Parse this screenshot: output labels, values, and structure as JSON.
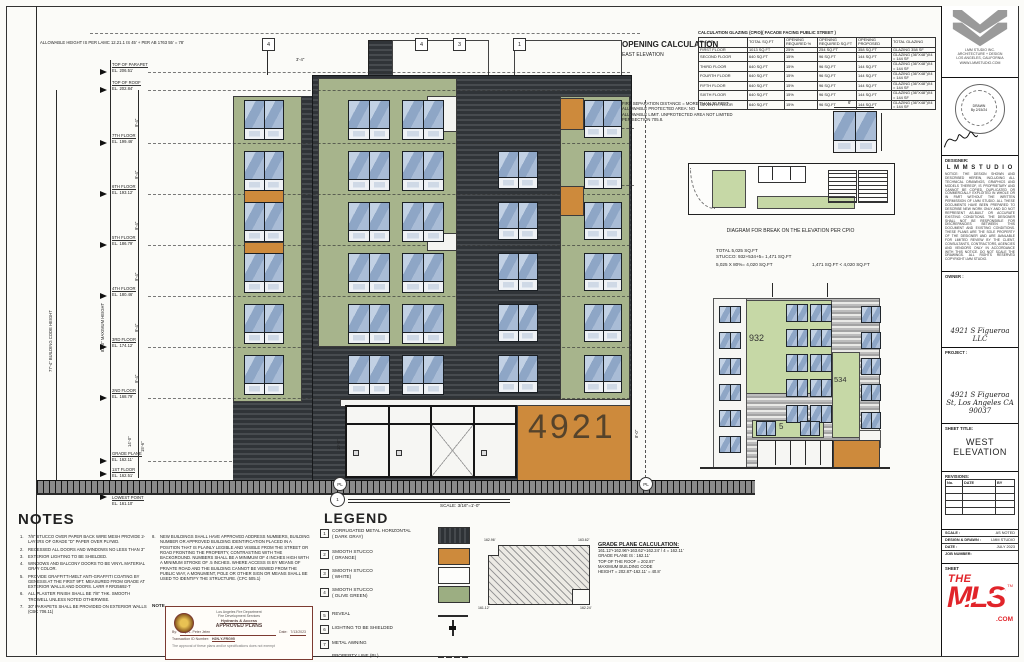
{
  "colors": {
    "olive": "#a7b48c",
    "light_green": "#c6d8a6",
    "orange": "#cd8a3c",
    "dark_metal": "#3a3e42",
    "window_blue": "#8ea6c6",
    "mls_red": "#e1242a",
    "stamp_maroon": "#7c3a31"
  },
  "grid_bubbles": [
    "4",
    "4",
    "3",
    "1"
  ],
  "dims": {
    "allowable": "ALLOWABLE HEIGHT IS PER LAMC 12.21.1 IS 45' + PER AB 1763 55' = 78'",
    "floor": "9'-4\"",
    "first": "14'-0\"",
    "ground": "15'-6\"",
    "right": "8'-0\"",
    "left": "10'-0\"",
    "top": "3'-4\"",
    "win": "6'",
    "bch": "77'-4\"  BUILDING CODE HEIGHT",
    "maxh": "82'-0\"  MAXIMUM HEIGHT"
  },
  "levels": [
    {
      "label": "TOP OF PARAPET",
      "el": "EL. 206.51'"
    },
    {
      "label": "TOP OF ROOF",
      "el": "EL. 202.84'"
    },
    {
      "label": "7TH FLOOR",
      "el": "EL. 199.46'"
    },
    {
      "label": "6TH FLOOR",
      "el": "EL. 193.12'"
    },
    {
      "label": "5TH FLOOR",
      "el": "EL. 186.79'"
    },
    {
      "label": "4TH FLOOR",
      "el": "EL. 180.46'"
    },
    {
      "label": "3RD FLOOR",
      "el": "EL. 174.12'"
    },
    {
      "label": "2ND FLOOR",
      "el": "EL. 168.79'"
    },
    {
      "label": "GRADE PLANE",
      "el": "EL. 162.11'"
    },
    {
      "label": "1ST FLOOR",
      "el": "EL. 162.51'"
    },
    {
      "label": "LOWEST POINT",
      "el": "EL. 161.10'"
    }
  ],
  "building": {
    "number": "4921",
    "pl": "PL"
  },
  "opening_calc": {
    "heading": "OPENING CALCULATION",
    "sub": "EAST ELEVATION",
    "table_title": "CALCULATION GLAZING (CPIO)( FACADE FACING PUBLIC STREET )",
    "headers": [
      "FLOOR",
      "TOTAL SQ.FT",
      "OPENING REQUIRED %",
      "OPENING REQUIRED SQ.FT",
      "OPENING PROPOSED",
      "TOTAL GLAZING"
    ],
    "rows": [
      [
        "FIRST FLOOR",
        "1013 SQ.FT",
        "25%",
        "254 SQ.FT",
        "358 SQ.FT",
        "GLAZING 358 SF"
      ],
      [
        "SECOND FLOOR",
        "640 SQ.FT",
        "15%",
        "96 SQ.FT",
        "144 SQ.FT",
        "GLAZING (36\"X48\")X4 = 144 SF"
      ],
      [
        "THIRD FLOOR",
        "640 SQ.FT",
        "15%",
        "96 SQ.FT",
        "144 SQ.FT",
        "GLAZING (36\"X48\")X4 = 144 SF"
      ],
      [
        "FOURTH FLOOR",
        "640 SQ.FT",
        "15%",
        "96 SQ.FT",
        "144 SQ.FT",
        "GLAZING (36\"X48\")X4 = 144 SF"
      ],
      [
        "FIFTH FLOOR",
        "640 SQ.FT",
        "15%",
        "96 SQ.FT",
        "144 SQ.FT",
        "GLAZING (36\"X48\")X4 = 144 SF"
      ],
      [
        "SIXTH FLOOR",
        "640 SQ.FT",
        "15%",
        "96 SQ.FT",
        "144 SQ.FT",
        "GLAZING (36\"X48\")X4 = 144 SF"
      ],
      [
        "SEVENTH FLOOR",
        "640 SQ.FT",
        "15%",
        "96 SQ.FT",
        "144 SQ.FT",
        "GLAZING (36\"X48\")X4 = 144 SF"
      ]
    ]
  },
  "fire_note": {
    "lines": [
      "FIRE SEPARATION DISTANCE = MORE THAN 30 FEET",
      "ALLOWABLE PROTECTED AREA: NO",
      "ALLOWABLE LIMIT. UNPROTECTED AREA NOT LIMITED",
      "PER SECTION 705.8."
    ]
  },
  "break_diagram": {
    "title": "DIAGRAM FOR BREAK ON THE ELEVATION PER CPIO",
    "calc1": "TOTAL 5,025 SQ.FT",
    "calc2": "STUCCO: 932+534+5= 1,471 SQ.FT",
    "calc3a": "5,025 X 80%= 4,020 SQ.FT",
    "calc3b": "1,471 SQ.FT < 4,020 SQ.FT",
    "area1": "932",
    "area2": "534",
    "area3": "5"
  },
  "east_elevation": {
    "num": "1",
    "title": "EAST ELEVATION",
    "scale": "SCALE: 3/16\"=1'-0\""
  },
  "notes": {
    "title": "NOTES",
    "items": [
      {
        "n": "1.",
        "t": "7/8\" STUCCO OVER PAPER BACK WIRE MESH PROVIDE 2-LAYERS OF GRADE \"D\" PAPER OVER PLYWD."
      },
      {
        "n": "2.",
        "t": "RECESSED ALL DOORS AND WINDOWS NO LESS THAN 3\""
      },
      {
        "n": "3.",
        "t": "EXTERIOR LIGHTING TO BE SHIELDED."
      },
      {
        "n": "4.",
        "t": "WINDOWS AND BALCONY DOORS TO BE VINYL MATERIAL GRAY COLOR."
      },
      {
        "n": "5.",
        "t": "PROVIDE GRAFFITTI-MELT ANTI-GRAFFITI COATING BY GENESIS AT THE FIRST 9FT. MEASURED FROM GRADE AT EXTERIOR WALLS AND DOORS. LARR # RR25692-T"
      },
      {
        "n": "6.",
        "t": "ALL PLASTER FINISH SHALL BE 7/8\" THK. SMOOTH TROWELL UNLESS NOTED OTHERWISE."
      },
      {
        "n": "7.",
        "t": "30\" PARAPETS SHALL BE PROVIDED ON EXTERIOR WALLS (CBC 706.11)"
      },
      {
        "n": "8.",
        "t": "NEW BUILDINGS SHALL HAVE APPROVED ADDRESS NUMBERS, BUILDING NUMBER OR APPROVED BUILDING IDENTIFICATION PLACED IN A POSITION THAT IS PLAINLY LEGIBLE AND VISIBLE FROM THE STREET OR ROAD FRONTING THE PROPERTY, CONTRASTING WITH THE BACKGROUND. NUMBERS SHALL BE A MINIMUM OF 4 INCHES HIGH WITH A MINIMUM STROKE OF .5 INCHES. WHERE ACCESS IS BY MEANS OF PRIVATE ROAD AND THE BUILDING CANNOT BE VIEWED FROM THE PUBLIC WAY, A MONUMENT, POLE OR OTHER SIGN OR MEANS SHALL BE USED TO IDENTIFY THE STRUCTURE. (CFC 505.1)"
      }
    ],
    "note_label": "NOTE",
    "note1": "All downspouts to drain into planter. See civil plans for continuation.",
    "note2": "All roof runoff to drain to planter."
  },
  "legend": {
    "title": "LEGEND",
    "items": [
      {
        "n": "1",
        "a": "CORRUGATED METAL HORIZONTAL",
        "b": "( DARK GRAY)"
      },
      {
        "n": "2",
        "a": "SMOOTH STUCCO",
        "b": "( ORANGE)"
      },
      {
        "n": "3",
        "a": "SMOOTH STUCCO",
        "b": "( WHITE)"
      },
      {
        "n": "4",
        "a": "SMOOTH STUCCO",
        "b": "( OLIVE GREEN)"
      },
      {
        "n": "5",
        "a": "REVEAL",
        "b": ""
      },
      {
        "n": "6",
        "a": "LIGHTING TO BE SHIELDED",
        "b": ""
      },
      {
        "n": "7",
        "a": "METAL AWNING",
        "b": ""
      }
    ],
    "pl": "PROPERTY LINE (PL)"
  },
  "grade_calc": {
    "title": "GRADE PLANE CALCULATION:",
    "l1": "161.12'+162.96'+163.62'+162.24' / 4 = 162.11'",
    "l2": "GRADE PLANE IS : 162.11'",
    "l3": "TOP OF THE ROOF = 202.87'",
    "l4": "MAXIMUM BUILDING CODE",
    "l5": "HEIGHT = 202.87'-162.11' = 40.8'",
    "corners": [
      "162.96'",
      "163.62'",
      "161.12'",
      "162.24'"
    ]
  },
  "stamp": {
    "dept": "Los Angeles Fire Department",
    "division": "Fire Development Services",
    "sub": "Hydrants & Access",
    "approved": "APPROVED PLANS",
    "by_label": "By:",
    "by": "Insp. L. Peter Jelen",
    "date_label": "Date:",
    "date": "7/13/2023",
    "tid_label": "Transaction ID Number:",
    "tid": "H2N-Y-FRG95",
    "fine": "The approval of these plans and/or specifications does not exempt"
  },
  "titleblock": {
    "firm_lines": [
      "LMM STUDIO INC.",
      "ARCHITECTURE + DESIGN",
      "LOS ANGELES, CALIFORNIA",
      "WWW.LMMSTUDIO.COM"
    ],
    "seal1": "DRAWN",
    "seal2": "By 2/15/24",
    "designer_label": "DESIGNER:",
    "firm": "L M M   S T U D I O",
    "notice": "NOTICE: THE DESIGN SHOWN AND DESCRIBED HEREIN, INCLUDING ALL TECHNICAL DRAWINGS, GRAPHICS AND MODELS THEREOF, IS PROPRIETARY AND CANNOT BE COPIED, DUPLICATED OR COMMERCIALLY EXPLOITED IN WHOLE OR IN PART WITHOUT THE WRITTEN PERMISSION OF LMM STUDIO. ALL THESE DOCUMENTS HAVE BEEN PREPARED TO DESCRIBE NEW WORK ONLY AND DO NOT REPRESENT AS-BUILT OR ACCURATE EXISTING CONDITIONS. THE DESIGNER SHALL NOT BE RESPONSIBLE FOR DISCREPANCIES BETWEEN THIS DOCUMENT AND EXISTING CONDITIONS. THESE PLANS ARE THE SOLE PROPERTY OF THE DESIGNER AND ARE AVAILABLE FOR LIMITED REVIEW BY THE CLIENT, CONSULTANTS, CONTRACTORS, AGENCIES AND VENDORS ONLY IN ACCORDANCE WITH THIS NOTICE. DO NOT SCALE THE DRAWINGS. ALL RIGHTS RESERVED COPYRIGHT LMM STUDIO.",
    "owner_label": "OWNER :",
    "owner": "4921 S Figueroa LLC",
    "project_label": "PROJECT :",
    "project": "4921 S Figueroa St, Los Angeles CA 90037",
    "sheet_title_label": "SHEET TITLE:",
    "sheet_title_1": "WEST",
    "sheet_title_2": "ELEVATION",
    "revisions_label": "REVISIONS:",
    "rev_cols": [
      "No.",
      "DATE",
      "BY"
    ],
    "scale_label": "SCALE :",
    "scale_value": "AS NOTED",
    "dd_label": "DESIGN & DRAWN :",
    "dd_value": "LMM STUDIO",
    "date_label": "DATE :",
    "date_value": "JULY 2023",
    "job_label": "JOB NUMBER:",
    "sheet_label": "SHEET"
  },
  "mls": {
    "the": "THE",
    "mls": "MLS",
    "tm": "TM",
    "com": ".COM"
  }
}
